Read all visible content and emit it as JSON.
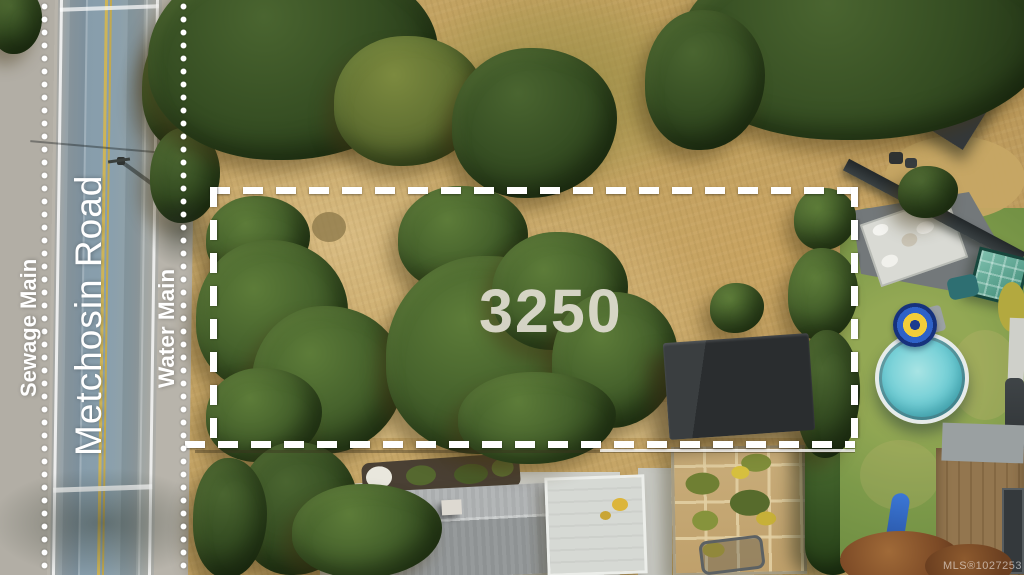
{
  "scene": {
    "alt": "Aerial drone photo of a vacant dry-grass lot outlined with a white dashed property boundary, large oak trees, a dark shed, Metchosin Road on the left with marked utility mains, neighbouring yards with a round pool, greenhouse, patio, houses and gardens"
  },
  "labels": {
    "sewage_main": "Sewage Main",
    "road_name": "Metchosin Road",
    "water_main": "Water Main"
  },
  "lot": {
    "number": "3250"
  },
  "watermark": {
    "text": "MLS®1027253"
  },
  "colors": {
    "boundary_dash": "#ffffff",
    "utility_dots": "#ffffff",
    "label_text": "#ffffff",
    "lot_number_text": "#dfdcd1",
    "asphalt_blue_gray": "#8aa0ad",
    "center_line_yellow": "#c9b054",
    "dry_grass_tan": "#c4a466",
    "tree_green": "#3f5a28",
    "lawn_green": "#7fa04f",
    "pool_water_teal": "#5fc4ce",
    "shed_roof_charcoal": "#2b2e30"
  }
}
